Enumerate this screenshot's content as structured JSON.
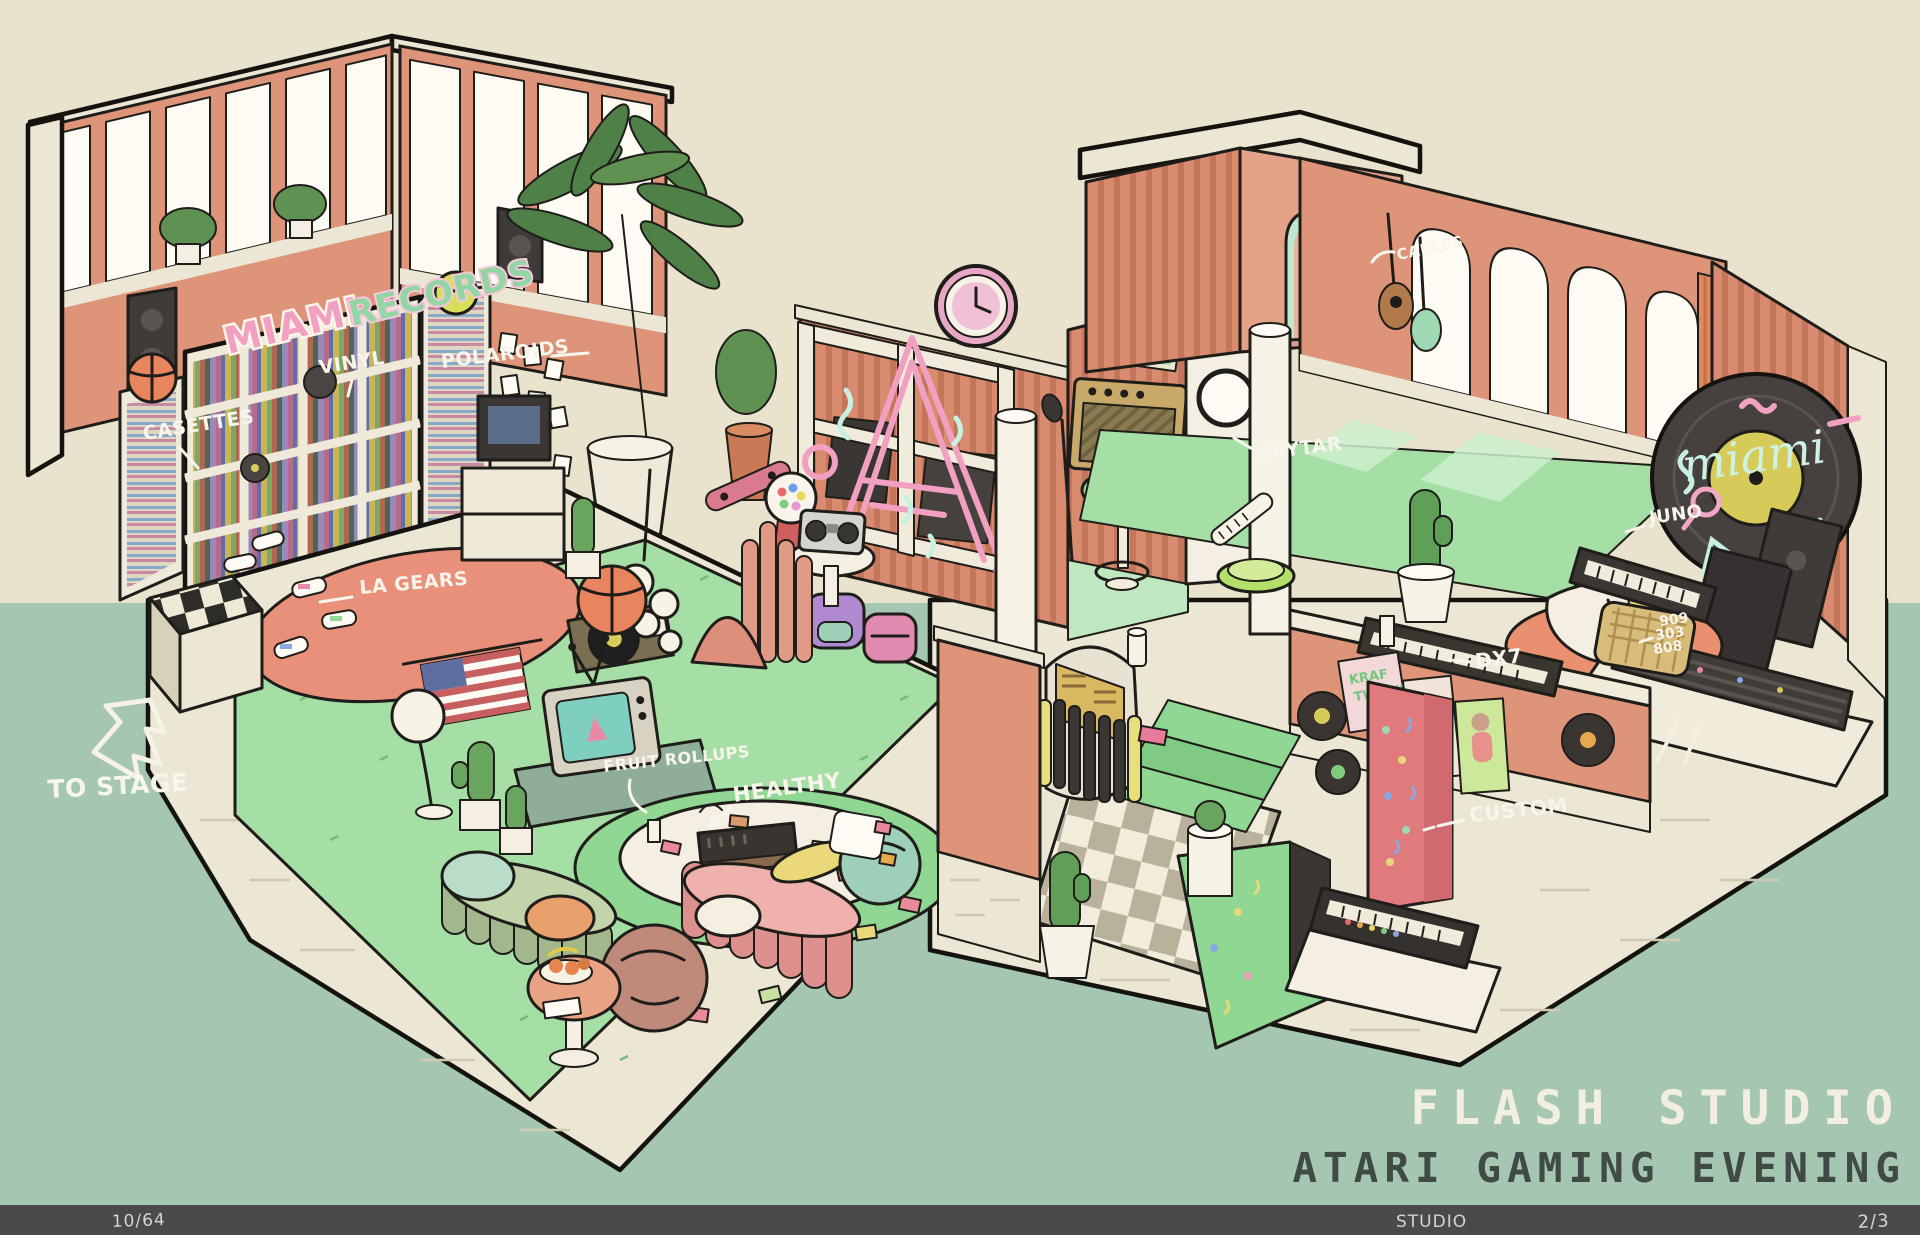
{
  "scene_title": {
    "main": "FLASH STUDIO",
    "sub": "ATARI GAMING EVENING"
  },
  "footer": {
    "left": "10/64",
    "center": "STUDIO",
    "right": "2/3"
  },
  "signs": {
    "shop_line1": "MIAMI",
    "shop_line2": "RECORDS",
    "record_neon": "miami",
    "poster_line1": "KRAF",
    "poster_line2": "TWERK"
  },
  "annotations": {
    "casettes": "CASETTES",
    "vinyl": "VINYL",
    "polaroids": "POLAROIDS",
    "la_gears": "LA GEARS",
    "to_stage": "TO STAGE",
    "fruit_rollups": "FRUIT ROLLUPS",
    "healthy": "HEALTHY",
    "keytar": "KEYTAR",
    "cables": "CABLES",
    "juno": "JUNO",
    "drum_909": "909",
    "drum_303": "303",
    "drum_808": "808",
    "dx7": "DX7",
    "custom": "CUSTOM"
  },
  "palette": {
    "bg_top": "#e9e2cc",
    "bg_bottom": "#a5c7b2",
    "footer_bar": "#4a4a4a",
    "cream": "#ece6d4",
    "salmon_wall": "#dd9478",
    "slat_wall": "#d98b6f",
    "mint_floor": "#a5dfa5",
    "mint_bright": "#8fd792",
    "rug_salmon": "#e8907a",
    "neon_pink": "#f2a0c2",
    "neon_mint": "#c8f0e0",
    "title_light": "#f2efe0",
    "title_dark": "#404b46",
    "ink": "#1f1d1a"
  }
}
